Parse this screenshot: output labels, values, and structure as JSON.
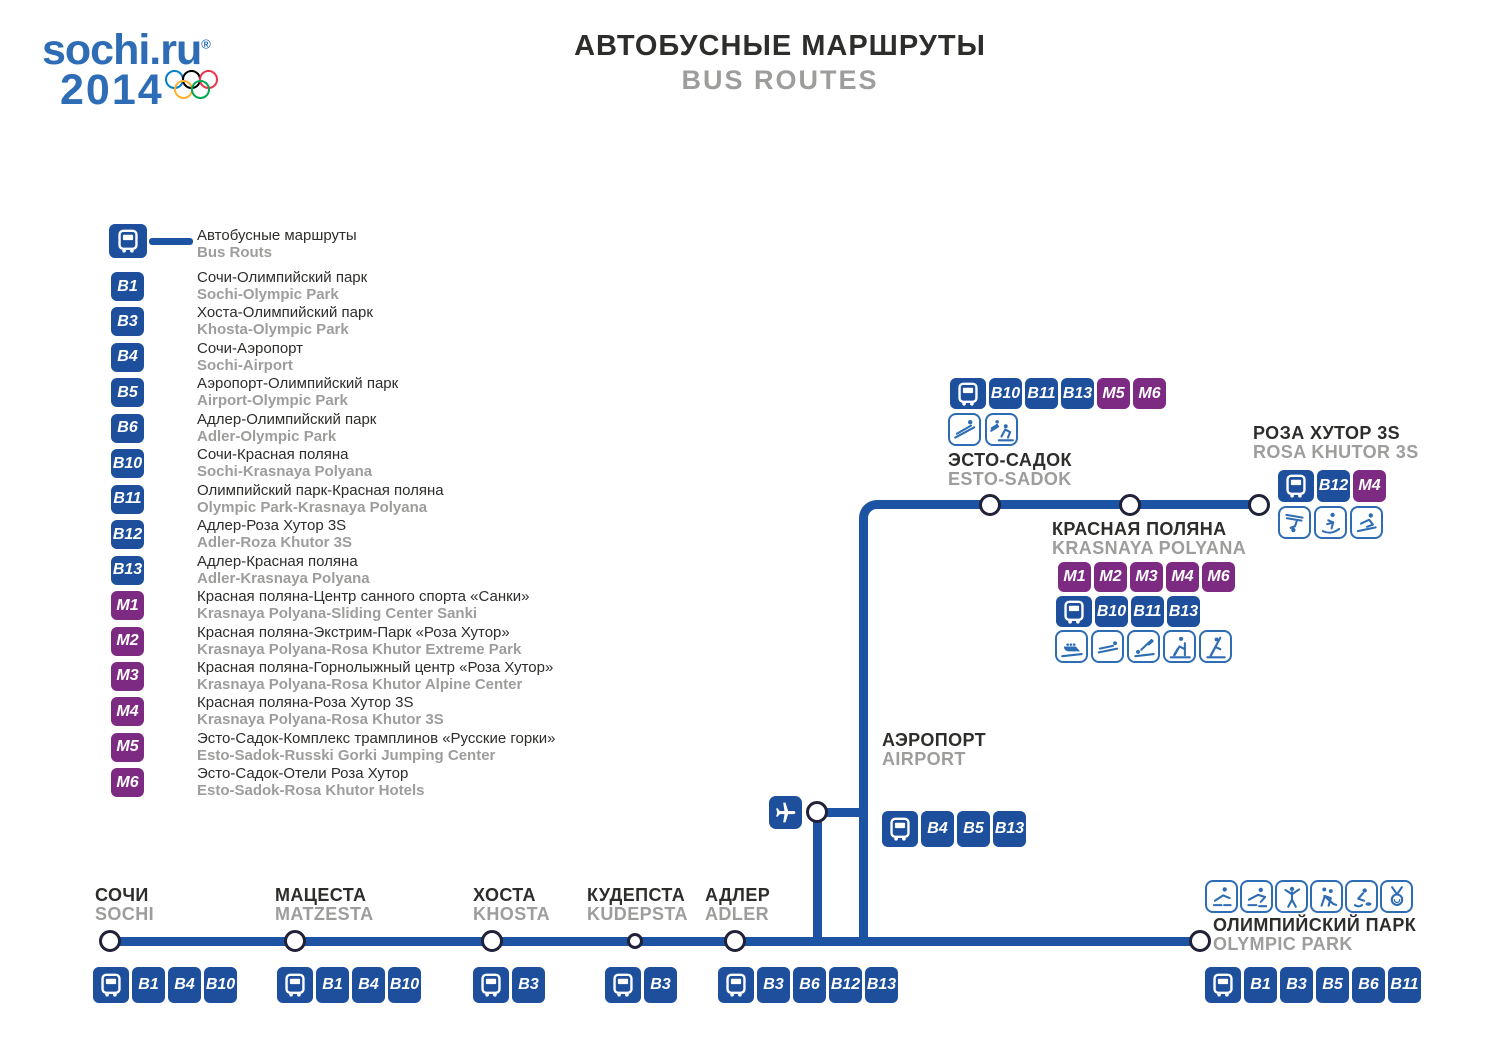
{
  "header": {
    "logo_line1": "sochi.ru",
    "logo_reg": "®",
    "logo_line2": "2014",
    "title_ru": "АВТОБУСНЫЕ МАРШРУТЫ",
    "title_en": "BUS ROUTES"
  },
  "colors": {
    "route_blue": "#1d4f9c",
    "route_purple": "#7d2a82",
    "line_blue": "#1d53a3",
    "pictogram_blue": "#2e6cb3",
    "text_dark": "#2d2d2b",
    "text_gray": "#9d9d9c",
    "logo_blue": "#2e6db6",
    "ring_blue": "#0081C8",
    "ring_black": "#000000",
    "ring_red": "#EE334E",
    "ring_yellow": "#FCB131",
    "ring_green": "#00A651"
  },
  "legend": {
    "busline_ru": "Автобусные маршруты",
    "busline_en": "Bus Routs",
    "routes": [
      {
        "id": "B1",
        "ru": "Сочи-Олимпийский парк",
        "en": "Sochi-Olympic Park"
      },
      {
        "id": "B3",
        "ru": "Хоста-Олимпийский парк",
        "en": "Khosta-Olympic Park"
      },
      {
        "id": "B4",
        "ru": "Сочи-Аэропорт",
        "en": "Sochi-Airport"
      },
      {
        "id": "B5",
        "ru": "Аэропорт-Олимпийский парк",
        "en": "Airport-Olympic Park"
      },
      {
        "id": "B6",
        "ru": "Адлер-Олимпийский парк",
        "en": "Adler-Olympic Park"
      },
      {
        "id": "B10",
        "ru": "Сочи-Красная поляна",
        "en": "Sochi-Krasnaya Polyana"
      },
      {
        "id": "B11",
        "ru": "Олимпийский парк-Красная поляна",
        "en": "Olympic Park-Krasnaya Polyana"
      },
      {
        "id": "B12",
        "ru": "Адлер-Роза Хутор 3S",
        "en": "Adler-Roza Khutor 3S"
      },
      {
        "id": "B13",
        "ru": "Адлер-Красная поляна",
        "en": "Adler-Krasnaya Polyana"
      },
      {
        "id": "M1",
        "ru": "Красная поляна-Центр санного спорта «Санки»",
        "en": "Krasnaya Polyana-Sliding Center Sanki"
      },
      {
        "id": "M2",
        "ru": "Красная поляна-Экстрим-Парк «Роза Хутор»",
        "en": "Krasnaya Polyana-Rosa Khutor Extreme Park"
      },
      {
        "id": "M3",
        "ru": "Красная поляна-Горнолыжный центр «Роза Хутор»",
        "en": "Krasnaya Polyana-Rosa Khutor Alpine Center"
      },
      {
        "id": "M4",
        "ru": "Красная поляна-Роза Хутор 3S",
        "en": "Krasnaya Polyana-Rosa Khutor 3S"
      },
      {
        "id": "M5",
        "ru": "Эсто-Садок-Комплекс трамплинов «Русские горки»",
        "en": "Esto-Sadok-Russki Gorki Jumping Center"
      },
      {
        "id": "M6",
        "ru": "Эсто-Садок-Отели Роза Хутор",
        "en": "Esto-Sadok-Rosa Khutor Hotels"
      }
    ]
  },
  "map": {
    "stations": [
      {
        "id": "sochi",
        "ru": "СОЧИ",
        "en": "SOCHI",
        "badges": [
          "bus",
          "B1",
          "B4",
          "B10"
        ],
        "pictograms": []
      },
      {
        "id": "matzesta",
        "ru": "МАЦЕСТА",
        "en": "MATZESTA",
        "badges": [
          "bus",
          "B1",
          "B4",
          "B10"
        ],
        "pictograms": []
      },
      {
        "id": "khosta",
        "ru": "ХОСТА",
        "en": "KHOSTA",
        "badges": [
          "bus",
          "B3"
        ],
        "pictograms": []
      },
      {
        "id": "kudepsta",
        "ru": "КУДЕПСТА",
        "en": "KUDEPSTA",
        "badges": [
          "bus",
          "B3"
        ],
        "pictograms": []
      },
      {
        "id": "adler",
        "ru": "АДЛЕР",
        "en": "ADLER",
        "badges": [
          "bus",
          "B3",
          "B6",
          "B12",
          "B13"
        ],
        "pictograms": []
      },
      {
        "id": "airport",
        "ru": "АЭРОПОРТ",
        "en": "AIRPORT",
        "badges": [
          "bus",
          "B4",
          "B5",
          "B13"
        ],
        "pictograms": []
      },
      {
        "id": "esto-sadok",
        "ru": "ЭСТО-САДОК",
        "en": "ESTO-SADOK",
        "badges": [
          "bus",
          "B10",
          "B11",
          "B13",
          "M5",
          "M6"
        ],
        "pictograms": [
          "ski-jumping",
          "nordic-combined"
        ]
      },
      {
        "id": "krasnaya-polyana",
        "ru": "КРАСНАЯ ПОЛЯНА",
        "en": "KRASNAYA POLYANA",
        "badges_m": [
          "M1",
          "M2",
          "M3",
          "M4",
          "M6"
        ],
        "badges": [
          "bus",
          "B10",
          "B11",
          "B13"
        ],
        "pictograms": [
          "bobsleigh",
          "luge",
          "skeleton",
          "cross-country-skiing",
          "biathlon"
        ]
      },
      {
        "id": "rosa-khutor",
        "ru": "РОЗА ХУТОР 3S",
        "en": "ROSA KHUTOR 3S",
        "badges": [
          "bus",
          "B12",
          "M4"
        ],
        "pictograms": [
          "freestyle-skiing",
          "snowboard",
          "alpine-skiing"
        ]
      },
      {
        "id": "olympic-park",
        "ru": "ОЛИМПИЙСКИЙ ПАРК",
        "en": "OLYMPIC PARK",
        "badges": [
          "bus",
          "B1",
          "B3",
          "B5",
          "B6",
          "B11"
        ],
        "pictograms": [
          "short-track",
          "speed-skating",
          "figure-skating",
          "ice-hockey",
          "curling",
          "medals"
        ]
      }
    ]
  }
}
